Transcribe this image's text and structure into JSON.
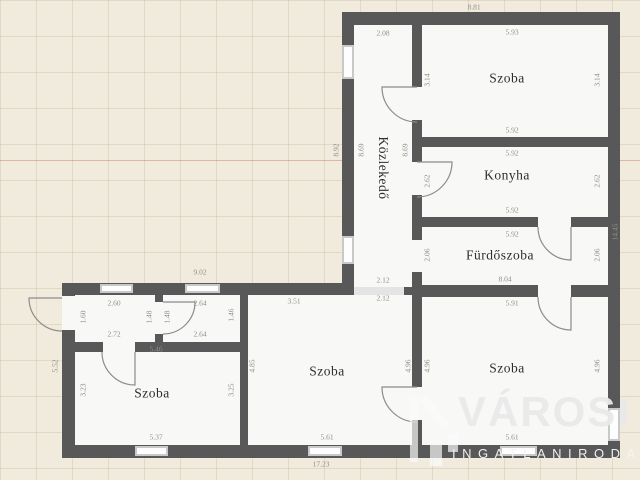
{
  "background": {
    "color": "#f1ebdd",
    "grid_color": "#aa9673",
    "accent_line_color": "#cd7369"
  },
  "plan": {
    "wall_color": "#585858",
    "room_fill": "#f8f8f6"
  },
  "rooms": [
    {
      "id": "room-top-right",
      "name": "Szoba",
      "width_m": "5.93",
      "depth_m": "3.14"
    },
    {
      "id": "kitchen",
      "name": "Konyha",
      "width_m": "5.92",
      "depth_m": "2.62"
    },
    {
      "id": "bathroom",
      "name": "Fürdőszoba",
      "width_m": "5.92",
      "depth_m": "2.06"
    },
    {
      "id": "hallway",
      "name": "Közlekedő",
      "width_m": "2.08",
      "depth_m": "8.69"
    },
    {
      "id": "room-bottom-right",
      "name": "Szoba",
      "width_m": "5.91",
      "depth_m": "4.96"
    },
    {
      "id": "room-bottom-middle",
      "name": "Szoba",
      "width_m": "5.61",
      "depth_m": "4.85"
    },
    {
      "id": "room-bottom-left",
      "name": "Szoba",
      "width_m": "5.37",
      "depth_m": "3.23"
    },
    {
      "id": "entry-room",
      "name": "",
      "width_m": "2.60",
      "depth_m": "1.60"
    },
    {
      "id": "small-room",
      "name": "",
      "width_m": "2.64",
      "depth_m": "1.48"
    }
  ],
  "overall_dimensions": {
    "top": "8.81",
    "right": "14.45",
    "bottom": "17.23",
    "left_upper_wing": "8.92",
    "left_lower_wing": "5.52",
    "bottom_wing_top": "9.02",
    "bathroom_row_total": "8.04"
  },
  "room_labels": [
    {
      "t": "Szoba",
      "x": 507,
      "y": 78
    },
    {
      "t": "Konyha",
      "x": 507,
      "y": 175
    },
    {
      "t": "Fürdőszoba",
      "x": 500,
      "y": 255
    },
    {
      "t": "Szoba",
      "x": 507,
      "y": 368
    },
    {
      "t": "Közlekedő",
      "x": 383,
      "y": 168,
      "v": 1
    },
    {
      "t": "Szoba",
      "x": 327,
      "y": 371
    },
    {
      "t": "Szoba",
      "x": 152,
      "y": 393
    }
  ],
  "dimension_labels": [
    {
      "t": "8.81",
      "x": 474,
      "y": 7
    },
    {
      "t": "2.08",
      "x": 383,
      "y": 33
    },
    {
      "t": "5.93",
      "x": 512,
      "y": 32
    },
    {
      "t": "8.92",
      "x": 336,
      "y": 150,
      "v": 1
    },
    {
      "t": "8.69",
      "x": 361,
      "y": 150,
      "v": 1
    },
    {
      "t": "8.69",
      "x": 405,
      "y": 150,
      "v": 1
    },
    {
      "t": "3.14",
      "x": 427,
      "y": 80,
      "v": 1
    },
    {
      "t": "3.14",
      "x": 597,
      "y": 80,
      "v": 1
    },
    {
      "t": "5.92",
      "x": 512,
      "y": 130
    },
    {
      "t": "5.92",
      "x": 512,
      "y": 153
    },
    {
      "t": "2.62",
      "x": 427,
      "y": 181,
      "v": 1
    },
    {
      "t": "2.62",
      "x": 597,
      "y": 181,
      "v": 1
    },
    {
      "t": "5.92",
      "x": 512,
      "y": 210
    },
    {
      "t": "5.92",
      "x": 512,
      "y": 234
    },
    {
      "t": "2.06",
      "x": 427,
      "y": 255,
      "v": 1
    },
    {
      "t": "2.06",
      "x": 597,
      "y": 255,
      "v": 1
    },
    {
      "t": "8.04",
      "x": 505,
      "y": 279
    },
    {
      "t": "14.45",
      "x": 615,
      "y": 232,
      "v": 1
    },
    {
      "t": "2.12",
      "x": 383,
      "y": 280
    },
    {
      "t": "2.12",
      "x": 383,
      "y": 298
    },
    {
      "t": "5.91",
      "x": 512,
      "y": 303
    },
    {
      "t": "4.96",
      "x": 408,
      "y": 366,
      "v": 1
    },
    {
      "t": "4.96",
      "x": 427,
      "y": 366,
      "v": 1
    },
    {
      "t": "4.96",
      "x": 597,
      "y": 366,
      "v": 1
    },
    {
      "t": "5.61",
      "x": 512,
      "y": 437
    },
    {
      "t": "9.02",
      "x": 200,
      "y": 272
    },
    {
      "t": "2.60",
      "x": 114,
      "y": 303
    },
    {
      "t": "2.64",
      "x": 200,
      "y": 303
    },
    {
      "t": "1.60",
      "x": 83,
      "y": 317,
      "v": 1
    },
    {
      "t": "1.48",
      "x": 149,
      "y": 317,
      "v": 1
    },
    {
      "t": "1.48",
      "x": 167,
      "y": 317,
      "v": 1
    },
    {
      "t": "1.46",
      "x": 231,
      "y": 315,
      "v": 1
    },
    {
      "t": "2.72",
      "x": 114,
      "y": 334
    },
    {
      "t": "2.64",
      "x": 200,
      "y": 334
    },
    {
      "t": "5.46",
      "x": 156,
      "y": 349
    },
    {
      "t": "3.51",
      "x": 294,
      "y": 301
    },
    {
      "t": "3.23",
      "x": 83,
      "y": 390,
      "v": 1
    },
    {
      "t": "3.25",
      "x": 231,
      "y": 390,
      "v": 1
    },
    {
      "t": "4.85",
      "x": 252,
      "y": 366,
      "v": 1
    },
    {
      "t": "5.52",
      "x": 55,
      "y": 366,
      "v": 1
    },
    {
      "t": "5.37",
      "x": 156,
      "y": 437
    },
    {
      "t": "5.61",
      "x": 327,
      "y": 437
    },
    {
      "t": "17.23",
      "x": 321,
      "y": 464
    }
  ],
  "watermark": {
    "brand": "VÁROSI",
    "agency": "INGATLANIRODA"
  }
}
